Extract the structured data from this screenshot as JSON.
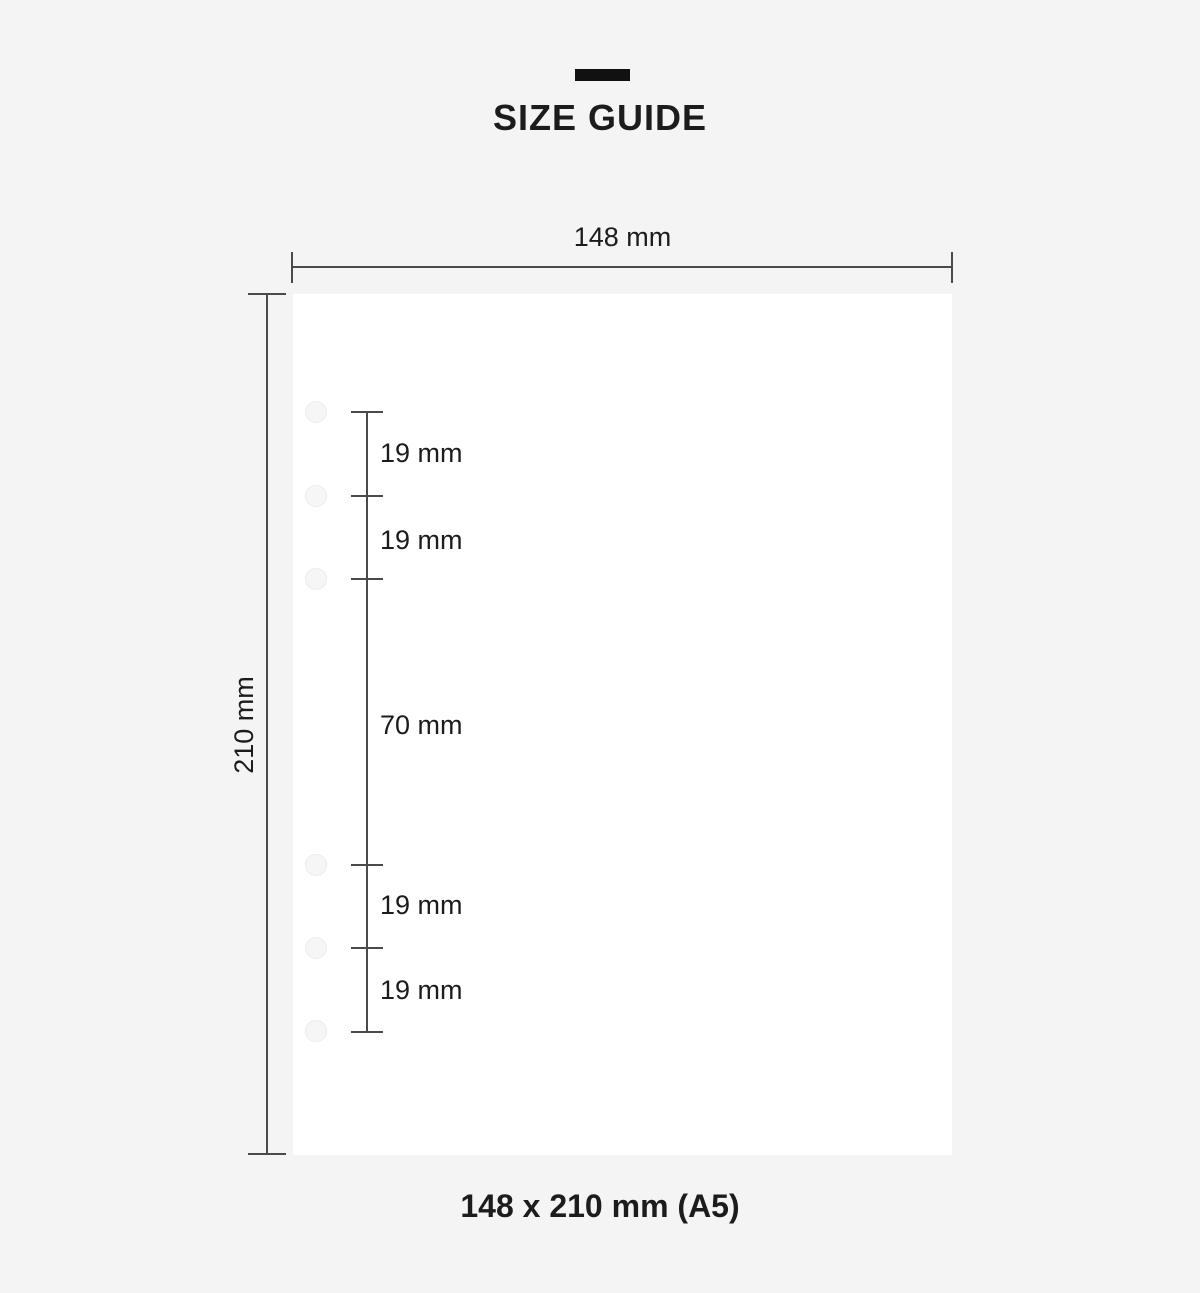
{
  "header": {
    "title": "SIZE GUIDE"
  },
  "paper": {
    "width_label": "148 mm",
    "height_label": "210 mm",
    "hole_count": 6
  },
  "ruler": {
    "segments": [
      {
        "label": "19 mm"
      },
      {
        "label": "19 mm"
      },
      {
        "label": "70 mm"
      },
      {
        "label": "19 mm"
      },
      {
        "label": "19 mm"
      }
    ]
  },
  "footer": {
    "caption": "148 x 210 mm (A5)"
  },
  "colors": {
    "background": "#f4f4f4",
    "paper": "#ffffff",
    "line": "#4a4a4a",
    "text": "#1c1c1c",
    "accent_bar": "#111111",
    "hole_fill": "#f6f6f6",
    "hole_border": "#ebebeb"
  }
}
